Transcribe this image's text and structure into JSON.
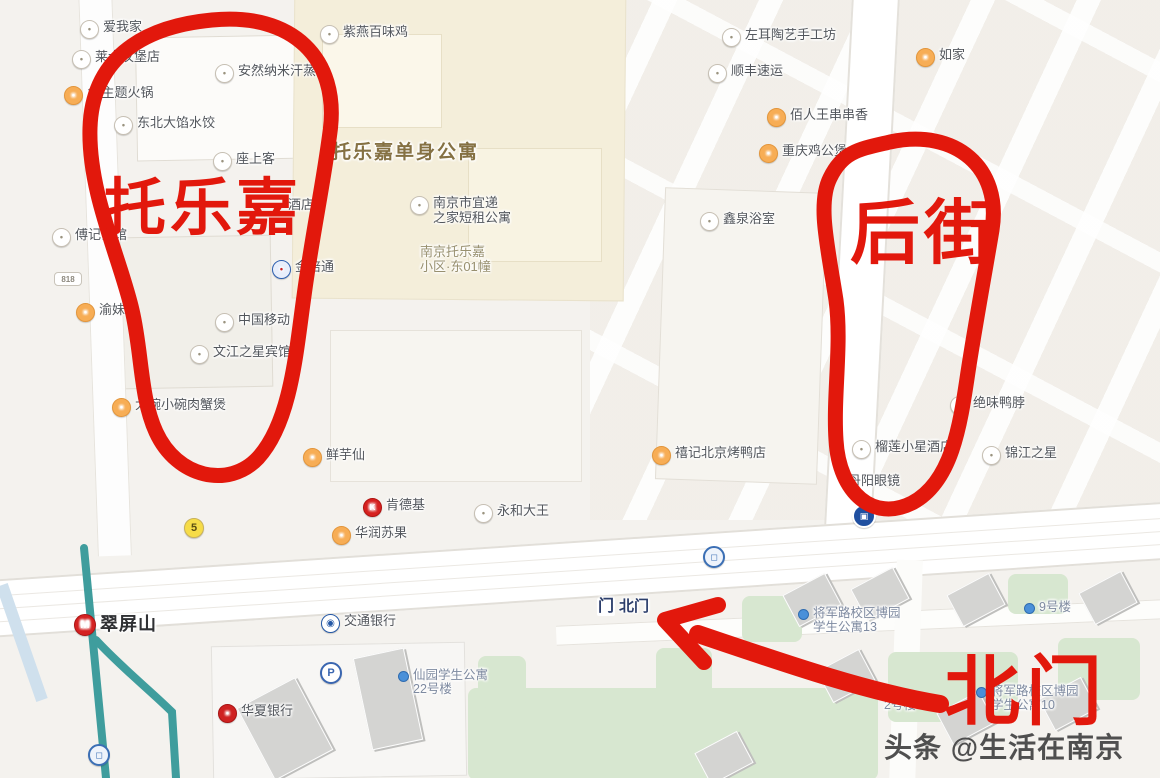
{
  "annotations": {
    "ink_color": "#e2180c",
    "circle_label_left": "托乐嘉",
    "circle_label_right": "后街",
    "arrow_label": "北门"
  },
  "watermark": {
    "text": "头条 @生活在南京"
  },
  "map": {
    "pois": [
      {
        "id": "aiwojia",
        "x": 80,
        "y": 20,
        "icon": "generic",
        "lines": [
          "爱我家"
        ]
      },
      {
        "id": "hualaishi-burger",
        "x": 72,
        "y": 50,
        "icon": "generic",
        "lines": [
          "莱士汉堡店"
        ]
      },
      {
        "id": "theme-hotpot-18",
        "x": 64,
        "y": 86,
        "icon": "food",
        "lines": [
          "18主题火锅"
        ]
      },
      {
        "id": "dongbei-dumplings",
        "x": 114,
        "y": 116,
        "icon": "generic",
        "lines": [
          "东北大馅水饺"
        ]
      },
      {
        "id": "ziyan-baiweiji",
        "x": 320,
        "y": 25,
        "icon": "generic",
        "lines": [
          "紫燕百味鸡"
        ]
      },
      {
        "id": "anran-sauna",
        "x": 215,
        "y": 64,
        "icon": "generic",
        "lines": [
          "安然纳米汗蒸馆"
        ]
      },
      {
        "id": "zuoshangke",
        "x": 213,
        "y": 152,
        "icon": "generic",
        "lines": [
          "座上客"
        ]
      },
      {
        "id": "tuolejia-apartment",
        "x": 332,
        "y": 142,
        "cls": "area-big",
        "lines": [
          "托乐嘉单身公寓"
        ]
      },
      {
        "id": "hotel-partial",
        "x": 288,
        "y": 198,
        "lines": [
          "酒店"
        ]
      },
      {
        "id": "yidi-apartment",
        "x": 410,
        "y": 196,
        "icon": "generic",
        "lines": [
          "南京市宜递",
          "之家短租公寓"
        ]
      },
      {
        "id": "tuolejia-community",
        "x": 420,
        "y": 245,
        "cls": "area-sub",
        "lines": [
          "南京托乐嘉",
          "小区·东01幢"
        ]
      },
      {
        "id": "jinbeitong",
        "x": 272,
        "y": 260,
        "icon": "blue",
        "lines": [
          "金倍通"
        ]
      },
      {
        "id": "china-mobile",
        "x": 215,
        "y": 313,
        "icon": "generic",
        "lines": [
          "中国移动"
        ]
      },
      {
        "id": "wenjiang-hotel",
        "x": 190,
        "y": 345,
        "icon": "generic",
        "lines": [
          "文江之星宾馆"
        ]
      },
      {
        "id": "fuji-restaurant",
        "x": 52,
        "y": 228,
        "icon": "generic",
        "lines": [
          "傅记饭馆"
        ]
      },
      {
        "id": "yumeier",
        "x": 76,
        "y": 303,
        "icon": "food",
        "lines": [
          "渝妹儿"
        ]
      },
      {
        "id": "rou-crab-pot",
        "x": 112,
        "y": 398,
        "icon": "food",
        "lines": [
          "大碗小碗肉蟹煲"
        ]
      },
      {
        "id": "xianyuxian",
        "x": 303,
        "y": 448,
        "icon": "food",
        "lines": [
          "鲜芋仙"
        ]
      },
      {
        "id": "kfc",
        "x": 363,
        "y": 498,
        "icon": "kfc",
        "lines": [
          "肯德基"
        ]
      },
      {
        "id": "yonghe-king",
        "x": 474,
        "y": 504,
        "icon": "generic",
        "lines": [
          "永和大王"
        ]
      },
      {
        "id": "huarun-sugo",
        "x": 332,
        "y": 526,
        "icon": "food",
        "lines": [
          "华润苏果"
        ]
      },
      {
        "id": "beijing-duck",
        "x": 652,
        "y": 446,
        "icon": "food",
        "lines": [
          "禧记北京烤鸭店"
        ]
      },
      {
        "id": "durian-hotel",
        "x": 852,
        "y": 440,
        "icon": "generic",
        "lines": [
          "榴莲小星酒店"
        ]
      },
      {
        "id": "danyang-glasses",
        "x": 848,
        "y": 474,
        "lines": [
          "丹阳眼镜"
        ]
      },
      {
        "id": "jinjiang-inn",
        "x": 982,
        "y": 446,
        "icon": "generic",
        "lines": [
          "锦江之星"
        ]
      },
      {
        "id": "juewei-duck-neck",
        "x": 950,
        "y": 396,
        "icon": "generic",
        "lines": [
          "绝味鸭脖"
        ]
      },
      {
        "id": "xinquan-bath",
        "x": 700,
        "y": 212,
        "icon": "generic",
        "lines": [
          "鑫泉浴室"
        ]
      },
      {
        "id": "zuoer-pottery",
        "x": 722,
        "y": 28,
        "icon": "generic",
        "lines": [
          "左耳陶艺手工坊"
        ]
      },
      {
        "id": "sf-express",
        "x": 708,
        "y": 64,
        "icon": "generic",
        "lines": [
          "顺丰速运"
        ]
      },
      {
        "id": "rujia-inn",
        "x": 916,
        "y": 48,
        "icon": "food",
        "lines": [
          "如家"
        ]
      },
      {
        "id": "bairenwang",
        "x": 767,
        "y": 108,
        "icon": "food",
        "lines": [
          "佰人王串串香"
        ]
      },
      {
        "id": "chongqing-jigongbao",
        "x": 759,
        "y": 144,
        "icon": "food",
        "lines": [
          "重庆鸡公煲"
        ]
      },
      {
        "id": "bocom-bank",
        "x": 321,
        "y": 614,
        "icon": "bocom",
        "lines": [
          "交通银行"
        ]
      },
      {
        "id": "north-gate",
        "x": 597,
        "y": 598,
        "icon": "gate",
        "cls": "poi-gate",
        "lines": [
          "北门"
        ]
      },
      {
        "id": "cuipingshan-station",
        "x": 74,
        "y": 614,
        "icon": "metro",
        "cls": "metro-station",
        "lines": [
          "翠屏山"
        ]
      },
      {
        "id": "huaxia-bank",
        "x": 218,
        "y": 704,
        "icon": "huaxia",
        "lines": [
          "华夏银行"
        ]
      },
      {
        "id": "xianyuan-dorm-22",
        "x": 398,
        "y": 668,
        "icon": "dot",
        "cls": "dorm",
        "lines": [
          "仙园学生公寓",
          "22号楼"
        ]
      },
      {
        "id": "boyuan-dorm-13",
        "x": 798,
        "y": 606,
        "icon": "dot",
        "cls": "dorm",
        "lines": [
          "将军路校区博园",
          "学生公寓13"
        ]
      },
      {
        "id": "building-9",
        "x": 1024,
        "y": 600,
        "icon": "dot",
        "cls": "dorm",
        "lines": [
          "9号楼"
        ]
      },
      {
        "id": "boyuan-dorm-10",
        "x": 976,
        "y": 684,
        "icon": "dot",
        "cls": "dorm",
        "lines": [
          "将军路校区博园",
          "学生公寓10"
        ]
      },
      {
        "id": "building-2",
        "x": 884,
        "y": 698,
        "cls": "dorm",
        "lines": [
          "2号楼"
        ]
      }
    ],
    "markers": [
      {
        "id": "parking",
        "type": "parking",
        "x": 320,
        "y": 662,
        "text": "P"
      },
      {
        "id": "road-badge-5",
        "type": "badge5",
        "x": 184,
        "y": 518,
        "text": "5"
      },
      {
        "id": "road-badge-818",
        "type": "badge818",
        "x": 54,
        "y": 272,
        "text": "818"
      },
      {
        "id": "bus-stop",
        "type": "bus",
        "x": 852,
        "y": 504,
        "text": ""
      },
      {
        "id": "metro-entrance-a",
        "type": "entrance",
        "x": 703,
        "y": 546,
        "text": ""
      },
      {
        "id": "metro-entrance-b",
        "type": "entrance",
        "x": 88,
        "y": 744,
        "text": ""
      }
    ],
    "icon_glyphs": {
      "generic": "•",
      "food": "•",
      "kfc": "K",
      "metro": "M",
      "bocom": "◉",
      "huaxia": "•",
      "blue": "•",
      "gate": "门",
      "dot": ""
    }
  }
}
